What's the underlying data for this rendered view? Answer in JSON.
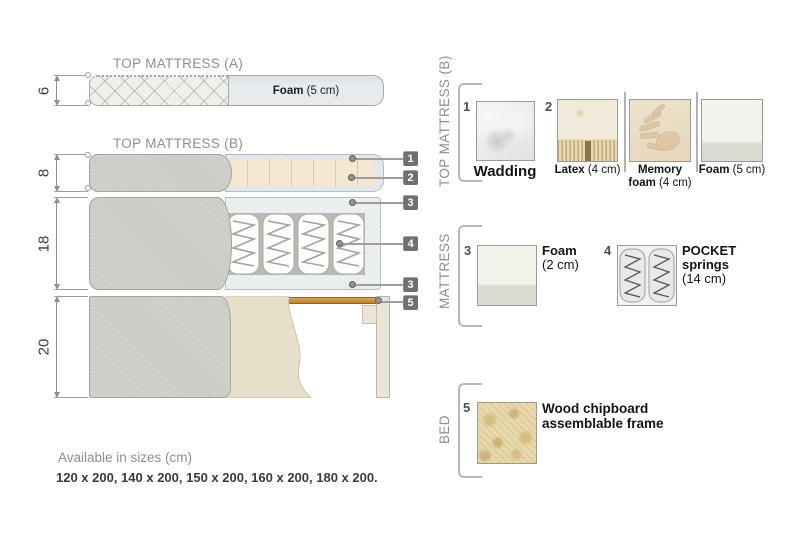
{
  "colors": {
    "badge_gray": "#707070",
    "fabric_gray": "#c9cbc5",
    "latex_cream": "#f4e8d2",
    "wadding_blue_gray": "#dee3e8",
    "wood_slat": "#c28d2e",
    "chipboard_beige": "#e8daad",
    "heading_gray": "#8e8e8e",
    "text_dark": "#2b2b2b"
  },
  "diagram": {
    "top_mattress_a": {
      "title": "TOP MATTRESS (A)",
      "dimension": "6",
      "foam_bold": "Foam",
      "foam_rest": " (5 cm)"
    },
    "top_mattress_b": {
      "title": "TOP MATTRESS (B)",
      "dimension": "8"
    },
    "mattress": {
      "dimension": "18"
    },
    "bed": {
      "dimension": "20"
    },
    "callouts": {
      "n1": "1",
      "n2": "2",
      "n3": "3",
      "n4": "4",
      "n3b": "3",
      "n5": "5"
    }
  },
  "legend": {
    "top_mattress_b": {
      "label": "TOP MATTRESS (B)",
      "wadding": {
        "num": "1",
        "name": "Wadding"
      },
      "latex": {
        "num": "2",
        "bold": "Latex",
        "rest": " (4 cm)"
      },
      "memory": {
        "line1": "Memory",
        "line2_bold": "foam",
        "line2_rest": " (4 cm)"
      },
      "foam": {
        "bold": "Foam",
        "rest": " (5 cm)"
      }
    },
    "mattress": {
      "label": "MATTRESS",
      "foam": {
        "num": "3",
        "bold": "Foam",
        "rest": "(2 cm)"
      },
      "pocket": {
        "num": "4",
        "line1": "POCKET",
        "line2": "springs",
        "line3": "(14 cm)"
      }
    },
    "bed": {
      "label": "BED",
      "frame": {
        "num": "5",
        "line1": "Wood chipboard",
        "line2": "assemblable frame"
      }
    }
  },
  "footer": {
    "line1": "Available in sizes (cm)",
    "line2": "120 x 200, 140 x 200, 150 x 200, 160 x 200, 180 x 200."
  }
}
